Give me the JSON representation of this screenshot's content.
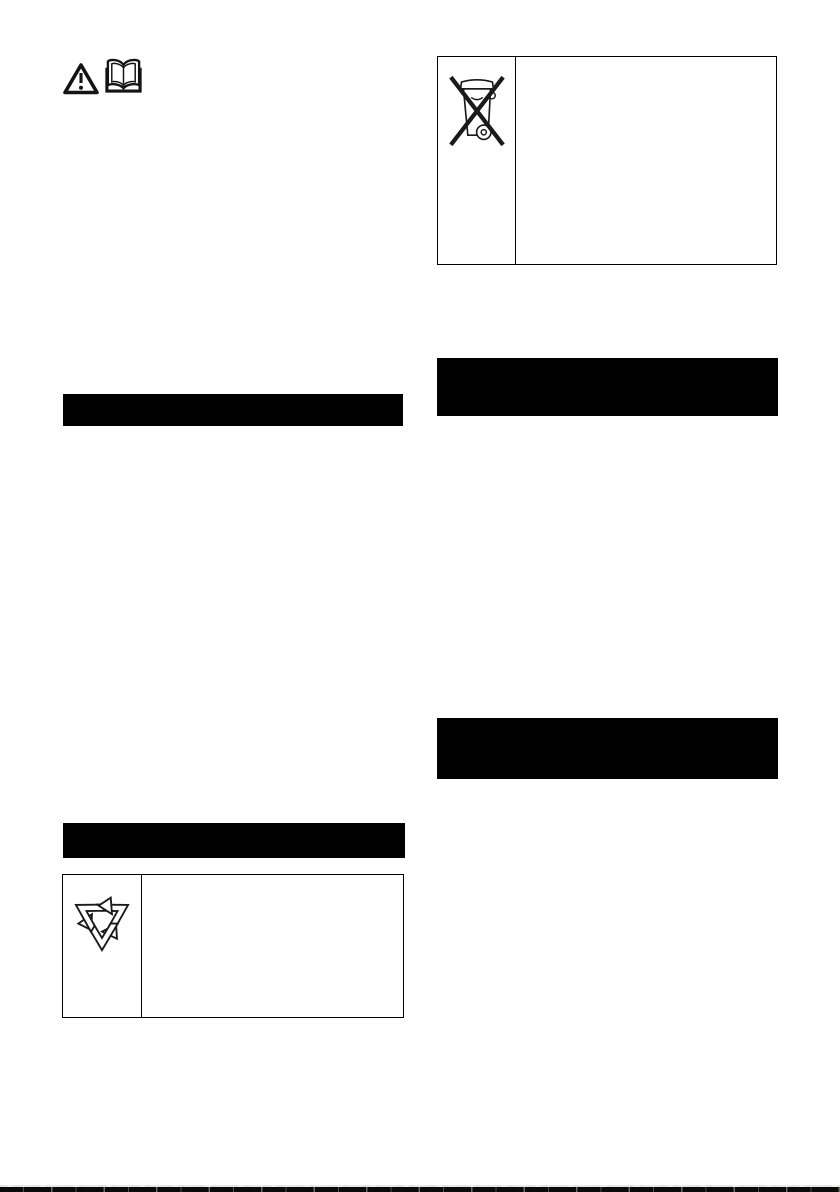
{
  "page": {
    "kind": "scanned manual page",
    "background_color": "#ffffff",
    "ink_color": "#000000"
  },
  "top_left_icons": {
    "warning_icon": "warning-triangle-exclamation",
    "read_manual_icon": "open-book"
  },
  "right_column": {
    "weee_table": {
      "symbol_icon": "crossed-out-wheeled-bin",
      "symbol_cell_text": "",
      "content_cell_text": ""
    },
    "redacted_bar_1": {
      "type": "solid-black-heading-bar",
      "color": "#000000",
      "text": ""
    },
    "redacted_bar_2": {
      "type": "solid-black-heading-bar",
      "color": "#000000",
      "text": ""
    }
  },
  "left_column": {
    "redacted_bar_1": {
      "type": "solid-black-heading-bar",
      "color": "#000000",
      "text": ""
    },
    "redacted_bar_2": {
      "type": "solid-black-heading-bar",
      "color": "#000000",
      "text": ""
    },
    "recycling_table": {
      "symbol_icon": "recycling-mobius-loop",
      "symbol_cell_text": "",
      "content_cell_text": ""
    }
  },
  "footer": {
    "scan_edge": "dashed-black-page-bottom-edge"
  }
}
